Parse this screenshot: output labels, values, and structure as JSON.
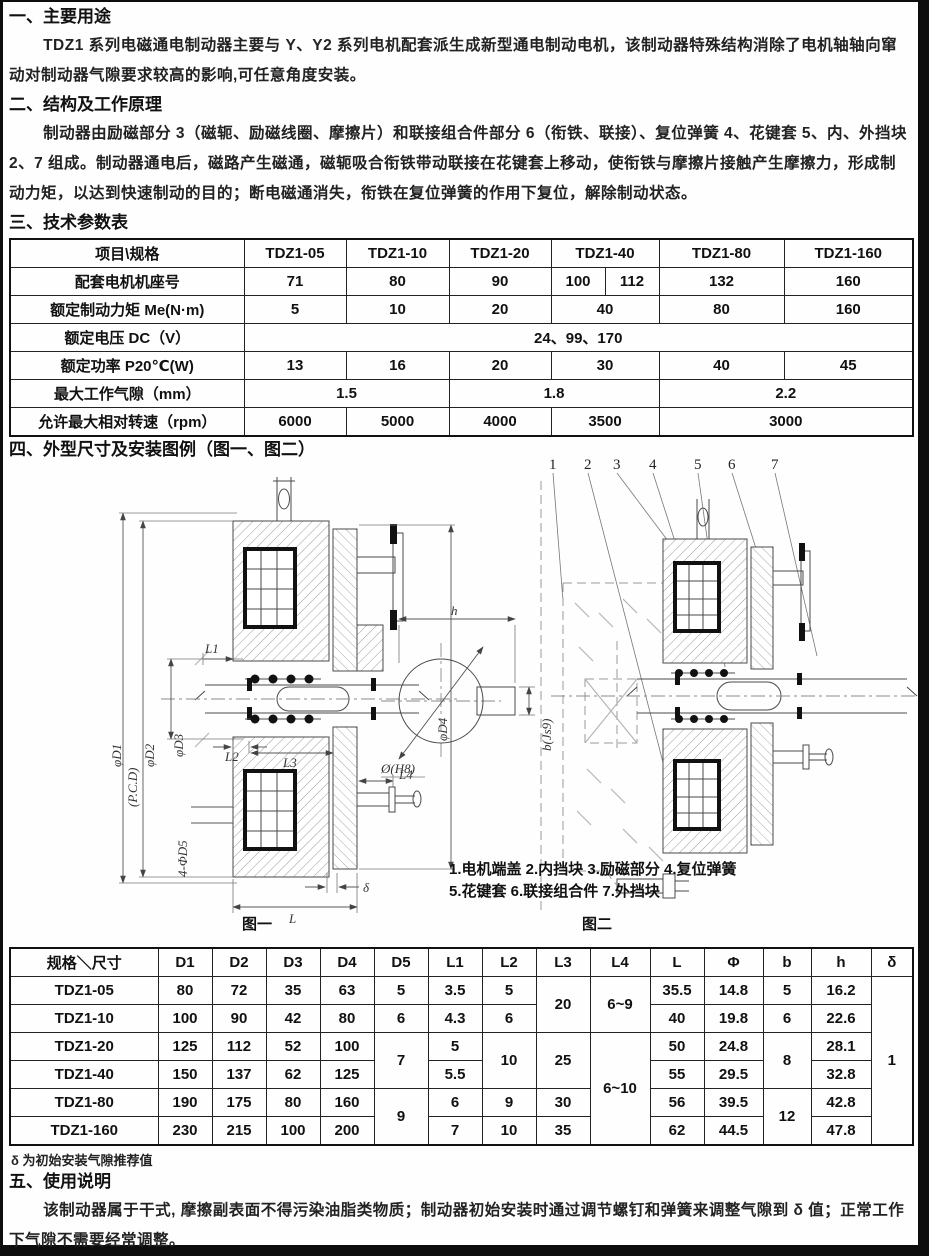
{
  "doc": {
    "s1_heading": "一、主要用途",
    "s1_para": "TDZ1 系列电磁通电制动器主要与 Y、Y2 系列电机配套派生成新型通电制动电机，该制动器特殊结构消除了电机轴轴向窜动对制动器气隙要求较高的影响,可任意角度安装。",
    "s2_heading": "二、结构及工作原理",
    "s2_para": "制动器由励磁部分 3（磁轭、励磁线圈、摩擦片）和联接组合件部分 6（衔铁、联接）、复位弹簧 4、花键套 5、内、外挡块 2、7 组成。制动器通电后，磁路产生磁通，磁轭吸合衔铁带动联接在花键套上移动，使衔铁与摩擦片接触产生摩擦力，形成制动力矩，以达到快速制动的目的；断电磁通消失，衔铁在复位弹簧的作用下复位，解除制动状态。",
    "s3_heading": "三、技术参数表",
    "s4_heading": "四、外型尺寸及安装图例（图一、图二）",
    "s5_heading": "五、使用说明",
    "s5_para": "该制动器属于干式, 摩擦副表面不得污染油脂类物质；制动器初始安装时通过调节螺钉和弹簧来调整气隙到 δ 值；正常工作下气隙不需要经常调整。",
    "dims_note": "δ 为初始安装气隙推荐值"
  },
  "params_table": {
    "col_header_label": "项目\\规格",
    "col_headers": [
      "TDZ1-05",
      "TDZ1-10",
      "TDZ1-20",
      "TDZ1-40",
      "TDZ1-80",
      "TDZ1-160"
    ],
    "frame_label": "配套电机机座号",
    "frame_values": [
      "71",
      "80",
      "90",
      "100",
      "112",
      "132",
      "160"
    ],
    "torque_label": "额定制动力矩 Me(N·m)",
    "torque_values": [
      "5",
      "10",
      "20",
      "40",
      "80",
      "160"
    ],
    "voltage_label": "额定电压 DC（V）",
    "voltage_value": "24、99、170",
    "power_label": "额定功率 P20℃(W)",
    "power_values": [
      "13",
      "16",
      "20",
      "30",
      "40",
      "45"
    ],
    "gap_label": "最大工作气隙（mm）",
    "gap_values": [
      "1.5",
      "1.8",
      "2.2"
    ],
    "speed_label": "允许最大相对转速（rpm）",
    "speed_values": [
      "6000",
      "5000",
      "4000",
      "3500",
      "3000"
    ]
  },
  "figure1": {
    "caption": "图一",
    "labels": {
      "d1": "φD1",
      "pcd": "(P.C.D)",
      "d2": "φD2",
      "d3": "φD3",
      "d4": "φD4",
      "l1": "L1",
      "l2": "L2",
      "l3": "L3",
      "l4": "L4",
      "d5": "4-ΦD5",
      "delta": "δ",
      "l": "L"
    }
  },
  "keyway": {
    "h": "h",
    "bore": "Ø(H8)",
    "key": "b(Js9)"
  },
  "figure2": {
    "caption": "图二",
    "numbers": [
      "1",
      "2",
      "3",
      "4",
      "5",
      "6",
      "7"
    ],
    "legend_line1": "1.电机端盖 2.内挡块 3.励磁部分 4.复位弹簧",
    "legend_line2": "5.花键套 6.联接组合件 7.外挡块"
  },
  "dims_table": {
    "header_label": "规格＼尺寸",
    "headers": [
      "D1",
      "D2",
      "D3",
      "D4",
      "D5",
      "L1",
      "L2",
      "L3",
      "L4",
      "L",
      "Φ",
      "b",
      "h",
      "δ"
    ],
    "specs": [
      "TDZ1-05",
      "TDZ1-10",
      "TDZ1-20",
      "TDZ1-40",
      "TDZ1-80",
      "TDZ1-160"
    ],
    "d1": [
      "80",
      "100",
      "125",
      "150",
      "190",
      "230"
    ],
    "d2": [
      "72",
      "90",
      "112",
      "137",
      "175",
      "215"
    ],
    "d3": [
      "35",
      "42",
      "52",
      "62",
      "80",
      "100"
    ],
    "d4": [
      "63",
      "80",
      "100",
      "125",
      "160",
      "200"
    ],
    "d5": [
      "5",
      "6",
      "7",
      "9"
    ],
    "l1": [
      "3.5",
      "4.3",
      "5",
      "5.5",
      "6",
      "7"
    ],
    "l2": [
      "5",
      "6",
      "10",
      "9",
      "10"
    ],
    "l3": [
      "20",
      "25",
      "30",
      "35"
    ],
    "l4": [
      "6~9",
      "6~10"
    ],
    "l": [
      "35.5",
      "40",
      "50",
      "55",
      "56",
      "62"
    ],
    "phi": [
      "14.8",
      "19.8",
      "24.8",
      "29.5",
      "39.5",
      "44.5"
    ],
    "b": [
      "5",
      "6",
      "8",
      "12"
    ],
    "h": [
      "16.2",
      "22.6",
      "28.1",
      "32.8",
      "42.8",
      "47.8"
    ],
    "delta": [
      "1"
    ]
  }
}
